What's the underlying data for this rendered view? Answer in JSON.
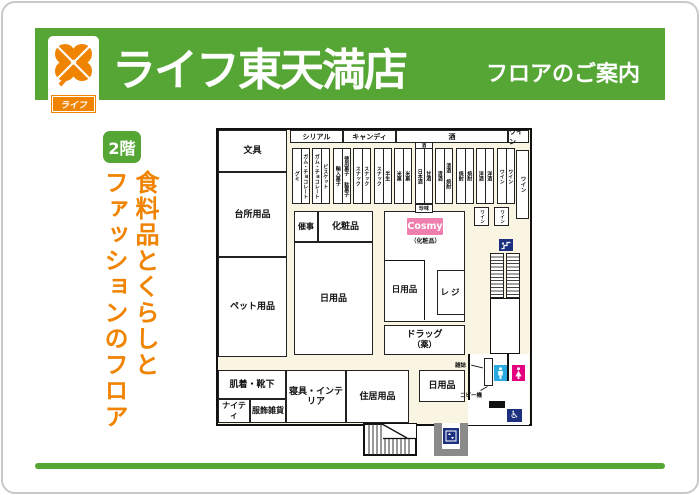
{
  "colors": {
    "brand_green": "#56a636",
    "brand_orange": "#f08300",
    "cosmy_pink": "#ef7fae",
    "mens_blue": "#29abe2",
    "womens_magenta": "#e4007f",
    "icon_navy": "#1d3080",
    "elevator_gray": "#8a8a8a",
    "plan_cream": "#faf5e3"
  },
  "header": {
    "logo_text": "ライフ",
    "store_name": "ライフ東天満店",
    "subtitle": "フロアのご案内"
  },
  "floor": {
    "badge": "2階",
    "tagline1": "食料品とくらしと",
    "tagline2": "ファッションのフロア"
  },
  "plan": {
    "top_bar": [
      "シリアル",
      "キャンディ",
      "酒",
      "ワイン"
    ],
    "rooms": {
      "stationery": "文具",
      "kitchen": "台所用品",
      "pet": "ペット用品",
      "underwear": "肌着・靴下",
      "nighty": "ナイティ",
      "fashion_goods": "服飾雑貨",
      "bedding": "寝具・インテリア",
      "housing": "住居用品",
      "daily_bottom": "日用品",
      "event": "催事",
      "cosmetics": "化粧品",
      "daily_big": "日用品",
      "daily_mid": "日用品",
      "register": "レジ",
      "drug_line1": "ドラッグ",
      "drug_line2": "（薬）",
      "cosmy": "Cosmy",
      "cosmy_sub": "（化粧品）",
      "wine_tall": "ワイン",
      "wine_a": "ワイン",
      "wine_b": "ワイン"
    },
    "aisles": [
      {
        "c1": "グミ",
        "c2": "ガム・チョコレート"
      },
      {
        "c1": "ガム・チョコレート",
        "c2": "ビスケット"
      },
      {
        "c1": "輸入菓子",
        "c2": "徳用菓子 駄菓子"
      },
      {
        "c1": "スナック",
        "c2": "スナック"
      },
      {
        "c1": "スナック",
        "c2": "半生"
      },
      {
        "c1": "米菓",
        "c2": "米菓"
      },
      {
        "c1": "日本酒",
        "c2": "甘酒"
      },
      {
        "c1": "清酒",
        "c2": "清酒 焼酎"
      },
      {
        "c1": "焼酎",
        "c2": "焼酎"
      },
      {
        "c1": "洋酒",
        "c2": "洋酒"
      },
      {
        "c1": "ワイン",
        "c2": "ワイン"
      }
    ],
    "aisle_sake": {
      "header": "酒",
      "footer": "珍味"
    },
    "facilities": {
      "magazine": "雑誌",
      "copier": "コピー機"
    }
  }
}
